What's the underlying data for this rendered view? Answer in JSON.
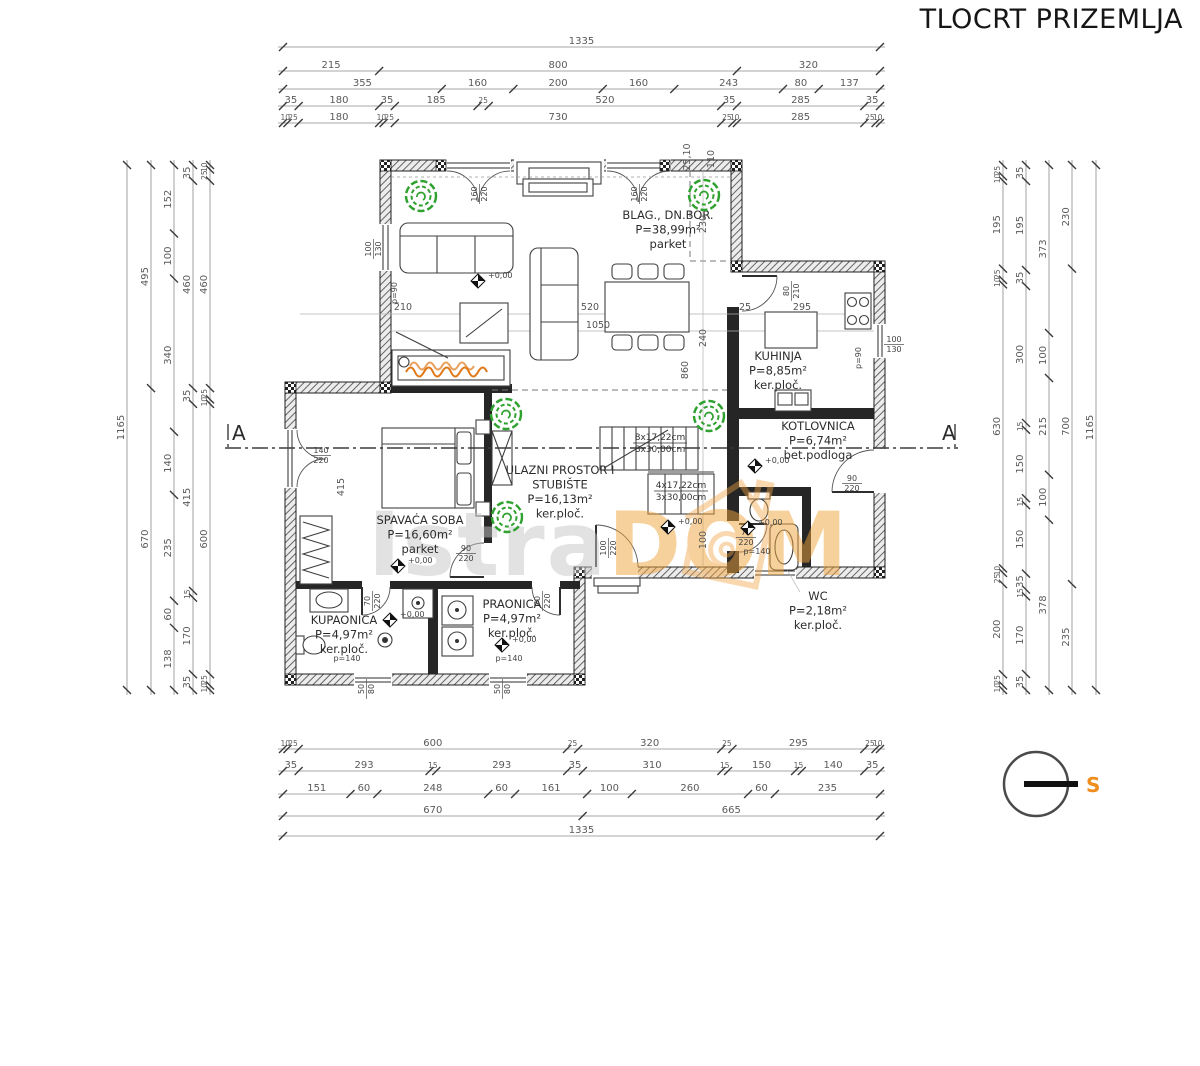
{
  "title": "TLOCRT PRIZEMLJA",
  "section": {
    "label": "A"
  },
  "compass": {
    "letter": "S"
  },
  "watermark": {
    "part1": "Istra",
    "part2": "DOM"
  },
  "level_label": "+0,00",
  "colors": {
    "accent_orange": "#ed9b3c",
    "flame_orange": "#e07818",
    "tree_green": "#2fa12f",
    "wall_dark": "#262626",
    "dim_gray": "#5a5a5a",
    "watermark_gray": "#c6c6c6"
  },
  "rooms": [
    {
      "id": "living",
      "lines": [
        "BLAG., DN.BOR.",
        "P=38,99m²",
        "parket"
      ],
      "x": 668,
      "y": 219
    },
    {
      "id": "kitchen",
      "lines": [
        "KUHINJA",
        "P=8,85m²",
        "ker.ploč."
      ],
      "x": 778,
      "y": 360
    },
    {
      "id": "boiler",
      "lines": [
        "KOTLOVNICA",
        "P=6,74m²",
        "bet.podloga"
      ],
      "x": 818,
      "y": 430
    },
    {
      "id": "bedroom",
      "lines": [
        "SPAVAĆA SOBA",
        "P=16,60m²",
        "parket"
      ],
      "x": 420,
      "y": 524
    },
    {
      "id": "entry",
      "lines": [
        "ULAZNI PROSTOR I",
        "STUBIŠTE",
        "P=16,13m²",
        "ker.ploč."
      ],
      "x": 560,
      "y": 474
    },
    {
      "id": "bathroom",
      "lines": [
        "KUPAONICA",
        "P=4,97m²",
        "ker.ploč."
      ],
      "x": 344,
      "y": 624
    },
    {
      "id": "laundry",
      "lines": [
        "PRAONICA",
        "P=4,97m²",
        "ker.ploč."
      ],
      "x": 512,
      "y": 608
    },
    {
      "id": "wc",
      "lines": [
        "WC",
        "P=2,18m²",
        "ker.ploč."
      ],
      "x": 818,
      "y": 600
    }
  ],
  "stair_notes": [
    {
      "lines": [
        "8x17,22cm",
        "8x30,00cm"
      ],
      "x": 660,
      "y": 440
    },
    {
      "lines": [
        "4x17,22cm",
        "3x30,00cm"
      ],
      "x": 681,
      "y": 488
    }
  ],
  "dim_chains": [
    {
      "id": "top-1",
      "dir": "h",
      "x1": 283,
      "x2": 880,
      "y": 47,
      "values": [
        1335
      ]
    },
    {
      "id": "top-2",
      "dir": "h",
      "x1": 283,
      "x2": 880,
      "y": 71,
      "values": [
        215,
        800,
        320
      ]
    },
    {
      "id": "top-3",
      "dir": "h",
      "x1": 283,
      "x2": 880,
      "y": 89,
      "values": [
        355,
        160,
        200,
        160,
        243,
        80,
        137
      ]
    },
    {
      "id": "top-4",
      "dir": "h",
      "x1": 283,
      "x2": 880,
      "y": 106,
      "values": [
        35,
        180,
        35,
        185,
        25,
        520,
        35,
        285,
        35
      ]
    },
    {
      "id": "top-5",
      "dir": "h",
      "x1": 283,
      "x2": 880,
      "y": 123,
      "values": [
        10,
        25,
        180,
        10,
        25,
        730,
        25,
        10,
        285,
        25,
        10
      ]
    },
    {
      "id": "bottom-1",
      "dir": "h",
      "x1": 283,
      "x2": 880,
      "y": 749,
      "values": [
        10,
        25,
        600,
        25,
        320,
        25,
        295,
        25,
        10
      ]
    },
    {
      "id": "bottom-2",
      "dir": "h",
      "x1": 283,
      "x2": 880,
      "y": 771,
      "values": [
        35,
        293,
        15,
        293,
        35,
        310,
        15,
        150,
        15,
        140,
        35
      ]
    },
    {
      "id": "bottom-3",
      "dir": "h",
      "x1": 283,
      "x2": 880,
      "y": 794,
      "values": [
        151,
        60,
        248,
        60,
        161,
        100,
        260,
        60,
        235
      ]
    },
    {
      "id": "bottom-4",
      "dir": "h",
      "x1": 283,
      "x2": 880,
      "y": 816,
      "values": [
        670,
        665
      ]
    },
    {
      "id": "bottom-5",
      "dir": "h",
      "x1": 283,
      "x2": 880,
      "y": 836,
      "values": [
        1335
      ]
    },
    {
      "id": "left-1",
      "dir": "v",
      "y1": 165,
      "y2": 690,
      "x": 127,
      "values": [
        1165
      ]
    },
    {
      "id": "left-2",
      "dir": "v",
      "y1": 165,
      "y2": 690,
      "x": 151,
      "values": [
        495,
        670
      ]
    },
    {
      "id": "left-3",
      "dir": "v",
      "y1": 165,
      "y2": 690,
      "x": 174,
      "values": [
        152,
        100,
        340,
        140,
        235,
        60,
        138
      ]
    },
    {
      "id": "left-4",
      "dir": "v",
      "y1": 165,
      "y2": 690,
      "x": 193,
      "values": [
        35,
        460,
        35,
        415,
        15,
        170,
        35
      ]
    },
    {
      "id": "left-5",
      "dir": "v",
      "y1": 165,
      "y2": 690,
      "x": 210,
      "values": [
        10,
        25,
        460,
        25,
        10,
        600,
        25,
        10
      ]
    },
    {
      "id": "right-1",
      "dir": "v",
      "y1": 165,
      "y2": 690,
      "x": 1003,
      "values": [
        25,
        10,
        195,
        25,
        10,
        630,
        10,
        25,
        200,
        25,
        10
      ]
    },
    {
      "id": "right-2",
      "dir": "v",
      "y1": 165,
      "y2": 690,
      "x": 1026,
      "values": [
        35,
        195,
        35,
        300,
        15,
        150,
        15,
        150,
        35,
        15,
        170,
        35
      ]
    },
    {
      "id": "right-3",
      "dir": "v",
      "y1": 165,
      "y2": 690,
      "x": 1049,
      "values": [
        373,
        100,
        215,
        100,
        378
      ]
    },
    {
      "id": "right-4",
      "dir": "v",
      "y1": 165,
      "y2": 690,
      "x": 1072,
      "values": [
        230,
        700,
        235
      ]
    },
    {
      "id": "right-5",
      "dir": "v",
      "y1": 165,
      "y2": 690,
      "x": 1096,
      "values": [
        1165
      ]
    }
  ],
  "inner_dims": [
    {
      "t": "210",
      "x": 403,
      "y": 310
    },
    {
      "t": "520",
      "x": 590,
      "y": 310
    },
    {
      "t": "25",
      "x": 745,
      "y": 310
    },
    {
      "t": "295",
      "x": 802,
      "y": 310
    },
    {
      "t": "1050",
      "x": 598,
      "y": 328
    },
    {
      "t": "25,10",
      "x": 690,
      "y": 157,
      "r": -90
    },
    {
      "t": "110",
      "x": 714,
      "y": 159,
      "r": -90
    },
    {
      "t": "230",
      "x": 706,
      "y": 224,
      "r": -90
    },
    {
      "t": "240",
      "x": 706,
      "y": 338,
      "r": -90
    },
    {
      "t": "860",
      "x": 688,
      "y": 370,
      "r": -90
    },
    {
      "t": "415",
      "x": 344,
      "y": 487,
      "r": -90
    },
    {
      "t": "100",
      "x": 706,
      "y": 540,
      "r": -90
    }
  ],
  "opening_labels": [
    {
      "t": "160/220",
      "x": 479,
      "y": 194,
      "r": -90
    },
    {
      "t": "160/220",
      "x": 639,
      "y": 194,
      "r": -90
    },
    {
      "t": "100/130",
      "x": 373,
      "y": 249,
      "r": -90
    },
    {
      "t": "p=90",
      "x": 397,
      "y": 293,
      "r": -90
    },
    {
      "t": "80/210",
      "x": 791,
      "y": 291,
      "r": -90
    },
    {
      "t": "100/130",
      "x": 894,
      "y": 344,
      "r": 0
    },
    {
      "t": "p=90",
      "x": 861,
      "y": 358,
      "r": -90
    },
    {
      "t": "140/220",
      "x": 321,
      "y": 455,
      "r": 0
    },
    {
      "t": "90/220",
      "x": 466,
      "y": 553,
      "r": 0
    },
    {
      "t": "100/220",
      "x": 608,
      "y": 548,
      "r": -90
    },
    {
      "t": "75/220",
      "x": 746,
      "y": 537,
      "r": 0
    },
    {
      "t": "90/220",
      "x": 852,
      "y": 483,
      "r": 0
    },
    {
      "t": "70/220",
      "x": 372,
      "y": 601,
      "r": -90
    },
    {
      "t": "70/220",
      "x": 542,
      "y": 601,
      "r": -90
    },
    {
      "t": "50/80",
      "x": 366,
      "y": 689,
      "r": -90
    },
    {
      "t": "50/80",
      "x": 502,
      "y": 689,
      "r": -90
    },
    {
      "t": "p=140",
      "x": 347,
      "y": 661,
      "r": 0
    },
    {
      "t": "p=140",
      "x": 509,
      "y": 661,
      "r": 0
    },
    {
      "t": "p=140",
      "x": 757,
      "y": 554,
      "r": 0
    }
  ],
  "level_markers": [
    {
      "x": 478,
      "y": 281
    },
    {
      "x": 398,
      "y": 566
    },
    {
      "x": 668,
      "y": 527
    },
    {
      "x": 755,
      "y": 466
    },
    {
      "x": 748,
      "y": 528
    },
    {
      "x": 390,
      "y": 620
    },
    {
      "x": 502,
      "y": 645
    }
  ],
  "trees": [
    {
      "x": 421,
      "y": 196
    },
    {
      "x": 704,
      "y": 195
    },
    {
      "x": 506,
      "y": 414
    },
    {
      "x": 709,
      "y": 416
    },
    {
      "x": 507,
      "y": 517
    }
  ]
}
